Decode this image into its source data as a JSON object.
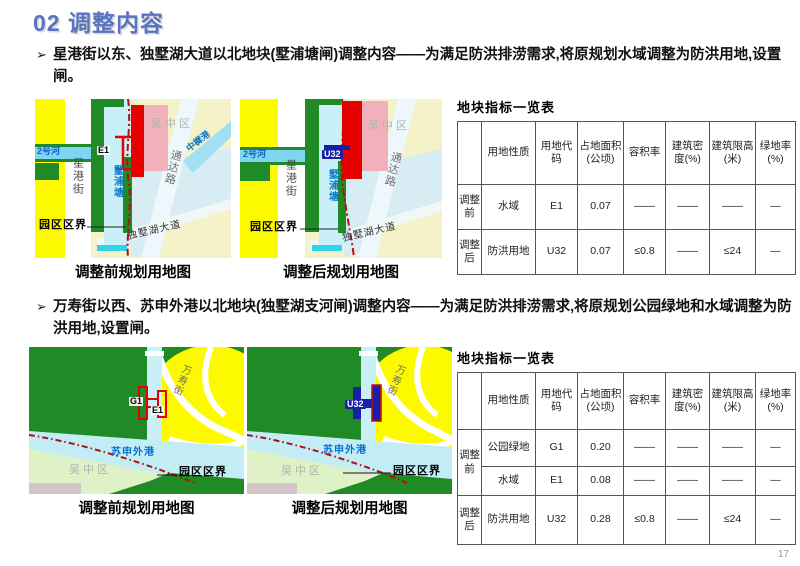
{
  "slide": {
    "title": "02 调整内容",
    "page_number": "17"
  },
  "bullet_marker": "➢",
  "captions": {
    "before": "调整前规划用地图",
    "after": "调整后规划用地图"
  },
  "table_title": "地块指标一览表",
  "table_headers": [
    "用地性质",
    "用地代码",
    "占地面积(公顷)",
    "容积率",
    "建筑密度(%)",
    "建筑限高(米)",
    "绿地率(%)"
  ],
  "s1": {
    "bullet": "星港街以东、独墅湖大道以北地块(墅浦塘闸)调整内容——为满足防洪排涝需求,将原规划水域调整为防洪用地,设置闸。",
    "map_before": {
      "labels": {
        "district": "吴中区",
        "river": "2号河",
        "street": "星港街",
        "pond": "墅浦塘",
        "marker": "E1",
        "road_tongda": "通达路",
        "stream": "中樨港",
        "road_dushuhu": "独墅湖大道",
        "boundary": "园区区界"
      }
    },
    "map_after": {
      "labels": {
        "district": "吴中区",
        "river": "2号河",
        "street": "星港街",
        "pond": "墅浦塘",
        "marker": "U32",
        "road_tongda": "通达路",
        "road_dushuhu": "独墅湖大道",
        "boundary": "园区区界"
      }
    },
    "table_rows": [
      {
        "phase": "调整前",
        "nature": "水域",
        "code": "E1",
        "area": "0.07",
        "far": "——",
        "density": "——",
        "height": "——",
        "green": "—"
      },
      {
        "phase": "调整后",
        "nature": "防洪用地",
        "code": "U32",
        "area": "0.07",
        "far": "≤0.8",
        "density": "——",
        "height": "≤24",
        "green": "—"
      }
    ]
  },
  "s2": {
    "bullet": "万寿街以西、苏申外港以北地块(独墅湖支河闸)调整内容——为满足防洪排涝需求,将原规划公园绿地和水域调整为防洪用地,设置闸。",
    "map_before": {
      "labels": {
        "district": "吴中区",
        "water": "苏申外港",
        "marker_g": "G1",
        "marker_e": "E1",
        "street": "万寿街",
        "boundary": "园区区界"
      }
    },
    "map_after": {
      "labels": {
        "district": "吴中区",
        "water": "苏申外港",
        "marker": "U32",
        "street": "万寿街",
        "boundary": "园区区界"
      }
    },
    "table_rows": [
      {
        "phase": "调整前",
        "nature": "公园绿地",
        "code": "G1",
        "area": "0.20",
        "far": "——",
        "density": "——",
        "height": "——",
        "green": "—"
      },
      {
        "nature": "水域",
        "code": "E1",
        "area": "0.08",
        "far": "——",
        "density": "——",
        "height": "——",
        "green": "—"
      },
      {
        "phase": "调整后",
        "nature": "防洪用地",
        "code": "U32",
        "area": "0.28",
        "far": "≤0.8",
        "density": "——",
        "height": "≤24",
        "green": "—"
      }
    ]
  },
  "colors": {
    "accent_blue": "#5873c0",
    "map_red": "#e60000",
    "map_green": "#1f8a26",
    "map_yellow": "#fdfa00",
    "water_blue": "#c9eff7",
    "pink_block": "#f2b0ba",
    "boundary_red": "#c00a0a",
    "marker_blue": "#1720a8"
  }
}
